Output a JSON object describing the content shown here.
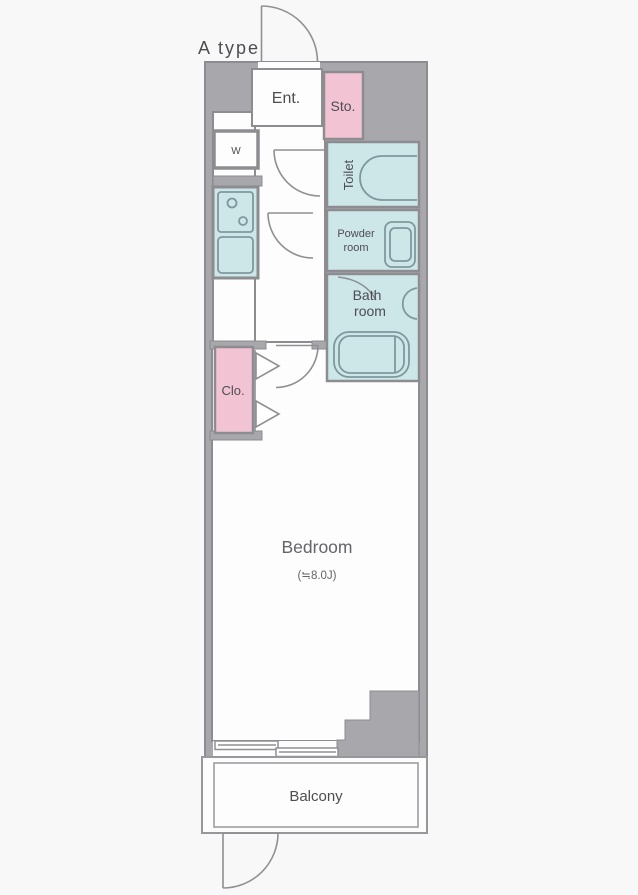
{
  "title": "A type",
  "colors": {
    "page_bg": "#f8f8f8",
    "wall_fill": "#a8a8ac",
    "wall_line": "#8d8d91",
    "room_fill": "#fdfdfd",
    "pink": "#f2c3d3",
    "blue": "#cde6e8",
    "fixture_line": "#7e999e",
    "door_line": "#909094",
    "label": "#4d4d52",
    "label_soft": "#64646a"
  },
  "rooms": {
    "entrance": {
      "label": "Ent."
    },
    "storage": {
      "label": "Sto."
    },
    "washer": {
      "label": "W"
    },
    "toilet": {
      "label": "Toilet"
    },
    "powder_room": {
      "line1": "Powder",
      "line2": "room"
    },
    "bath_room": {
      "line1": "Bath",
      "line2": "room"
    },
    "closet": {
      "label": "Clo."
    },
    "bedroom": {
      "label": "Bedroom",
      "size": "(≒8.0J)"
    },
    "balcony": {
      "label": "Balcony"
    }
  }
}
